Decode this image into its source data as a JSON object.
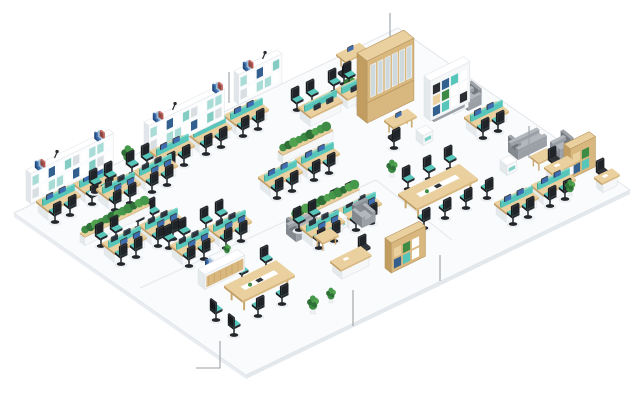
{
  "meta": {
    "description": "Isometric 3D office floor plan illustration with workstation benches, lounge areas, conference tables, shelving walls, plants and callout leader lines"
  },
  "palette": {
    "wood": "#d9b87f",
    "wood_dark": "#c19d61",
    "wood_light": "#ead09e",
    "white_furniture": "#ffffff",
    "teal": "#56c6ba",
    "teal_light": "#a9dcd6",
    "navy": "#2d5a96",
    "chair_black": "#26292e",
    "sofa_gray": "#9aa0a6",
    "plant_green": "#3e8b45",
    "screen_blue": "#3e6cb0",
    "glass": "#cdd9dd",
    "floor_fill": "#fafbfc",
    "floor_edge": "#e6eaee",
    "floor_line": "#e2e6ea",
    "callout_gray": "#9aa0a6"
  },
  "floor": {
    "corners": [
      [
        14,
        213
      ],
      [
        398,
        28
      ],
      [
        630,
        190
      ],
      [
        246,
        375
      ]
    ],
    "edge_drop": 4,
    "partitions": [
      [
        [
          140,
          288
        ],
        [
          376,
          180
        ]
      ],
      [
        [
          376,
          180
        ],
        [
          452,
          240
        ]
      ]
    ]
  },
  "callouts": [
    {
      "points": [
        [
          229,
          72
        ],
        [
          229,
          103
        ]
      ]
    },
    {
      "points": [
        [
          390,
          13
        ],
        [
          390,
          37
        ]
      ]
    },
    {
      "points": [
        [
          529,
          126
        ],
        [
          529,
          158
        ]
      ]
    },
    {
      "points": [
        [
          196,
          368
        ],
        [
          220,
          368
        ],
        [
          220,
          341
        ]
      ]
    },
    {
      "points": [
        [
          353,
          290
        ],
        [
          353,
          326
        ]
      ]
    },
    {
      "points": [
        [
          440,
          255
        ],
        [
          440,
          281
        ]
      ]
    }
  ],
  "items": [
    {
      "t": "shelfwall",
      "x": 144,
      "y": 152,
      "len": 84
    },
    {
      "t": "shelfwall",
      "x": 234,
      "y": 101,
      "len": 48
    },
    {
      "t": "shelfwall",
      "x": 26,
      "y": 200,
      "len": 92
    },
    {
      "t": "tallcab",
      "x": 357,
      "y": 115
    },
    {
      "t": "bookshelf",
      "x": 424,
      "y": 116,
      "w": 44,
      "h": 40,
      "body": "white"
    },
    {
      "t": "bookshelf",
      "x": 564,
      "y": 174,
      "w": 28,
      "h": 30,
      "body": "wood"
    },
    {
      "t": "bookshelf",
      "x": 385,
      "y": 268,
      "w": 38,
      "h": 30,
      "body": "wood"
    },
    {
      "t": "cab",
      "x": 446,
      "y": 108
    },
    {
      "t": "pod",
      "x": 150,
      "y": 162,
      "ch": "f"
    },
    {
      "t": "pod",
      "x": 187,
      "y": 144,
      "ch": "f"
    },
    {
      "t": "pod",
      "x": 224,
      "y": 126,
      "ch": "f"
    },
    {
      "t": "pod",
      "x": 96,
      "y": 200,
      "ch": "fb"
    },
    {
      "t": "pod",
      "x": 133,
      "y": 182,
      "ch": "fb"
    },
    {
      "t": "pod",
      "x": 36,
      "y": 212,
      "ch": "f"
    },
    {
      "t": "pod",
      "x": 73,
      "y": 194,
      "ch": "f"
    },
    {
      "t": "pod",
      "x": 102,
      "y": 254,
      "ch": "fb"
    },
    {
      "t": "pod",
      "x": 139,
      "y": 236,
      "ch": "fb"
    },
    {
      "t": "pod",
      "x": 170,
      "y": 256,
      "ch": "fb"
    },
    {
      "t": "pod",
      "x": 207,
      "y": 238,
      "ch": "fb"
    },
    {
      "t": "pod",
      "x": 258,
      "y": 188,
      "ch": "f"
    },
    {
      "t": "pod",
      "x": 295,
      "y": 170,
      "ch": "f"
    },
    {
      "t": "pod",
      "x": 300,
      "y": 238,
      "ch": "fb"
    },
    {
      "t": "pod",
      "x": 337,
      "y": 220,
      "ch": "fb"
    },
    {
      "t": "pod",
      "x": 298,
      "y": 118,
      "ch": "b"
    },
    {
      "t": "pod",
      "x": 335,
      "y": 100,
      "ch": "b"
    },
    {
      "t": "pod",
      "x": 464,
      "y": 128,
      "ch": "f"
    },
    {
      "t": "pod",
      "x": 494,
      "y": 214,
      "ch": "f"
    },
    {
      "t": "pod",
      "x": 531,
      "y": 196,
      "ch": "f"
    },
    {
      "t": "ctable",
      "x": 224,
      "y": 300,
      "w": 58,
      "d": 24
    },
    {
      "t": "ctable",
      "x": 398,
      "y": 208,
      "w": 68,
      "d": 24
    },
    {
      "t": "chair",
      "x": 242,
      "y": 281,
      "rot": 0,
      "teal": true
    },
    {
      "t": "chair",
      "x": 266,
      "y": 269,
      "rot": 0,
      "teal": true
    },
    {
      "t": "chair",
      "x": 258,
      "y": 316,
      "rot": 2,
      "teal": true
    },
    {
      "t": "chair",
      "x": 282,
      "y": 304,
      "rot": 2,
      "teal": true
    },
    {
      "t": "chair",
      "x": 216,
      "y": 320,
      "rot": 1,
      "teal": true
    },
    {
      "t": "chair",
      "x": 234,
      "y": 335,
      "rot": 1,
      "teal": true
    },
    {
      "t": "chair",
      "x": 408,
      "y": 189,
      "rot": 0,
      "teal": true
    },
    {
      "t": "chair",
      "x": 429,
      "y": 179,
      "rot": 0,
      "teal": true
    },
    {
      "t": "chair",
      "x": 450,
      "y": 169,
      "rot": 0,
      "teal": true
    },
    {
      "t": "chair",
      "x": 424,
      "y": 228,
      "rot": 2,
      "teal": true
    },
    {
      "t": "chair",
      "x": 445,
      "y": 218,
      "rot": 2,
      "teal": true
    },
    {
      "t": "chair",
      "x": 466,
      "y": 208,
      "rot": 2,
      "teal": true
    },
    {
      "t": "chair",
      "x": 487,
      "y": 198,
      "rot": 2,
      "teal": true
    },
    {
      "t": "sideboard",
      "x": 356,
      "y": 108,
      "len": 28
    },
    {
      "t": "sofa",
      "x": 424,
      "y": 114,
      "len": 34,
      "rot": 1
    },
    {
      "t": "armchair",
      "x": 458,
      "y": 103,
      "rot": 3
    },
    {
      "t": "cubetable",
      "x": 416,
      "y": 140
    },
    {
      "t": "sofa",
      "x": 508,
      "y": 152,
      "len": 32,
      "rot": 1
    },
    {
      "t": "armchair",
      "x": 550,
      "y": 152,
      "rot": 3
    },
    {
      "t": "lowtable",
      "x": 530,
      "y": 166,
      "w": 18,
      "d": 11
    },
    {
      "t": "cubetable",
      "x": 500,
      "y": 170
    },
    {
      "t": "chair",
      "x": 554,
      "y": 170,
      "rot": 0,
      "teal": false
    },
    {
      "t": "execdesk",
      "x": 544,
      "y": 178,
      "w": 26,
      "d": 11
    },
    {
      "t": "execdesk",
      "x": 594,
      "y": 188,
      "w": 20,
      "d": 10
    },
    {
      "t": "chair",
      "x": 602,
      "y": 182,
      "rot": 0,
      "teal": false
    },
    {
      "t": "armchair",
      "x": 352,
      "y": 220,
      "rot": 0
    },
    {
      "t": "cubetable",
      "x": 330,
      "y": 226
    },
    {
      "t": "lowtable",
      "x": 314,
      "y": 246,
      "w": 18,
      "d": 11
    },
    {
      "t": "sofa",
      "x": 286,
      "y": 234,
      "len": 30,
      "rot": 1
    },
    {
      "t": "chair",
      "x": 364,
      "y": 258,
      "rot": 0,
      "teal": false
    },
    {
      "t": "execdesk",
      "x": 330,
      "y": 272,
      "w": 34,
      "d": 14
    },
    {
      "t": "desk",
      "x": 336,
      "y": 66,
      "w": 26,
      "d": 12
    },
    {
      "t": "chair",
      "x": 344,
      "y": 84,
      "rot": 2,
      "teal": false
    },
    {
      "t": "desk",
      "x": 384,
      "y": 132,
      "w": 26,
      "d": 12
    },
    {
      "t": "chair",
      "x": 394,
      "y": 148,
      "rot": 2,
      "teal": false
    },
    {
      "t": "counter",
      "x": 198,
      "y": 284,
      "len": 44
    },
    {
      "t": "books",
      "x": 205,
      "y": 266
    },
    {
      "t": "plant",
      "x": 227,
      "y": 256,
      "s": 0.55
    },
    {
      "t": "plant",
      "x": 128,
      "y": 166,
      "s": 0.95
    },
    {
      "t": "plant",
      "x": 350,
      "y": 95,
      "s": 0.9
    },
    {
      "t": "plant",
      "x": 392,
      "y": 177,
      "s": 0.8
    },
    {
      "t": "plant",
      "x": 570,
      "y": 196,
      "s": 0.75
    },
    {
      "t": "plant",
      "x": 313,
      "y": 314,
      "s": 0.85
    },
    {
      "t": "plant",
      "x": 331,
      "y": 303,
      "s": 0.7
    },
    {
      "t": "hedge",
      "x": 80,
      "y": 242,
      "len": 72
    },
    {
      "t": "hedge",
      "x": 290,
      "y": 226,
      "len": 72
    },
    {
      "t": "hedge",
      "x": 278,
      "y": 160,
      "len": 56
    }
  ]
}
